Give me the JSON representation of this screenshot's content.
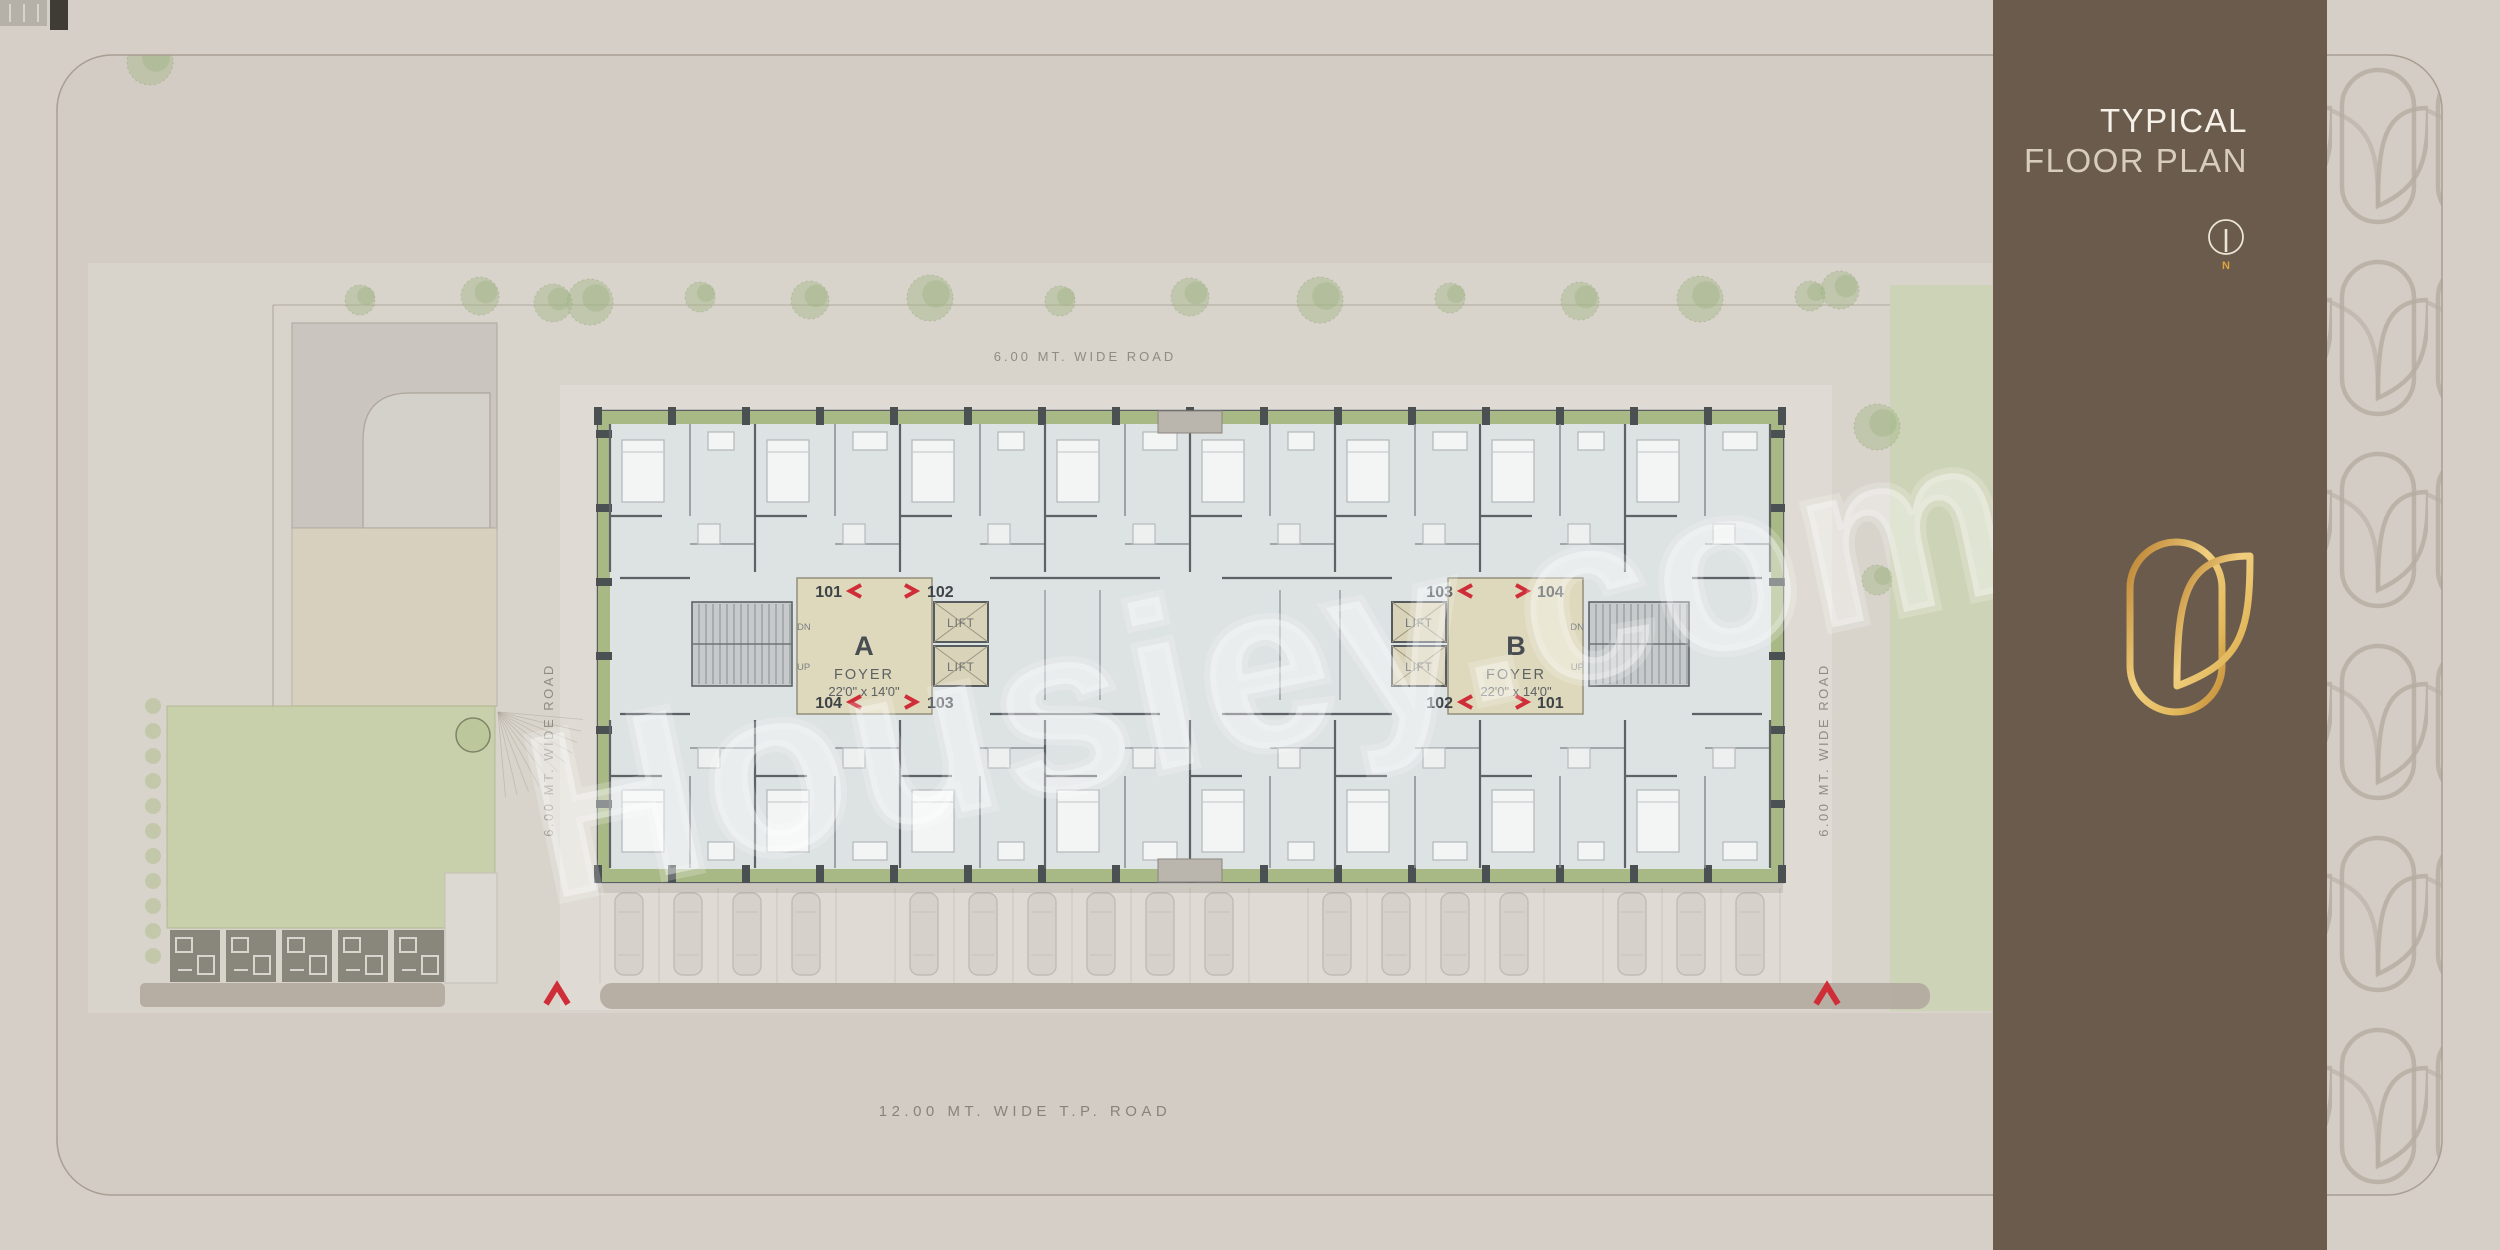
{
  "header": {
    "title_line1": "TYPICAL",
    "title_line2": "FLOOR PLAN"
  },
  "north": {
    "label": "N"
  },
  "watermark": {
    "text": "Housiey.com"
  },
  "roads": {
    "top": "6.00 MT. WIDE ROAD",
    "left": "6.00 MT. WIDE ROAD",
    "right": "6.00 MT. WIDE ROAD",
    "bottom": "12.00  MT.  WIDE  T.P.  ROAD"
  },
  "block_a": {
    "name": "A",
    "foyer": "FOYER",
    "dims": "22'0\" x 14'0\"",
    "dn": "DN",
    "up": "UP",
    "lift1": "LIFT",
    "lift2": "LIFT",
    "unit_tl": "101",
    "unit_tr": "102",
    "unit_bl": "104",
    "unit_br": "103"
  },
  "block_b": {
    "name": "B",
    "foyer": "FOYER",
    "dims": "22'0\" x 14'0\"",
    "dn": "DN",
    "up": "UP",
    "lift1": "LIFT",
    "lift2": "LIFT",
    "unit_tl": "103",
    "unit_tr": "104",
    "unit_bl": "102",
    "unit_br": "101"
  },
  "colors": {
    "sidebar_brown": "#6a5b4d",
    "accent_gold": "#e0a33c",
    "marker_red": "#cf2e38",
    "balcony_green": "#a9b986",
    "foyer_beige": "#ded8bc",
    "plan_fill": "#dde2e3",
    "wall_gray": "#5d6265"
  }
}
